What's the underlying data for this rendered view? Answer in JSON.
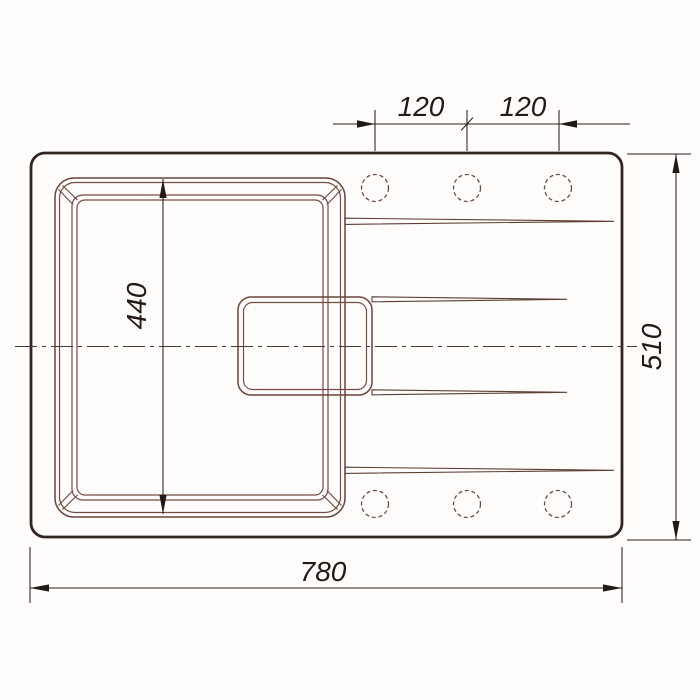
{
  "drawing": {
    "dim_labels": {
      "hole_spacing_1": "120",
      "hole_spacing_2": "120",
      "bowl_length": "440",
      "overall_depth": "510",
      "overall_width": "780"
    },
    "features": {
      "faucet_holes_top_row": 3,
      "faucet_holes_bottom_row": 3,
      "drainboard_grooves": 4,
      "bowls": 1,
      "drain_recess": 1
    },
    "colors": {
      "outline_thick": "#33241e",
      "line_thin": "#754c41",
      "dimension_line": "#2b1f19",
      "text": "#241a15",
      "background": "#fefdfc"
    }
  }
}
